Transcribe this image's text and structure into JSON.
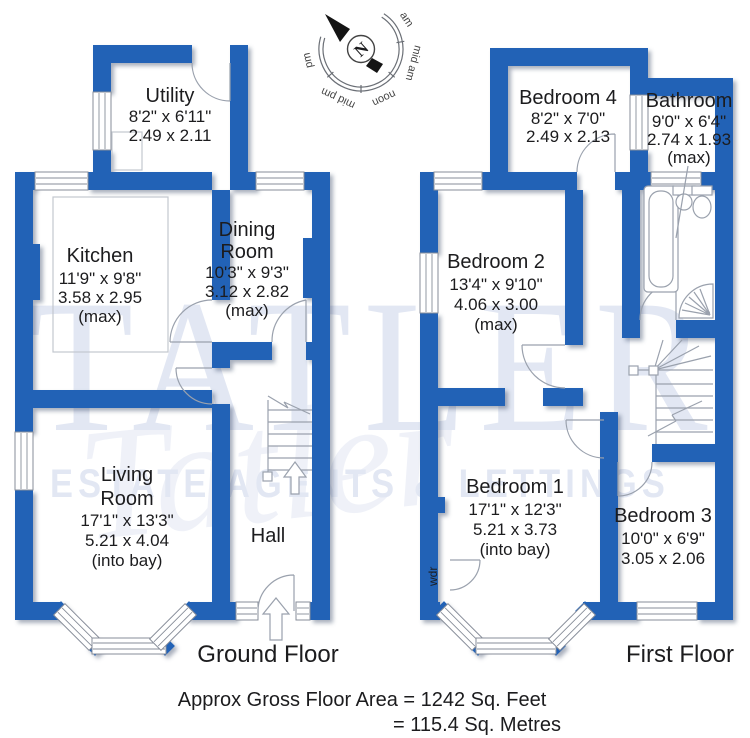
{
  "compass": {
    "north": "N",
    "sun_labels": [
      "am",
      "mid am",
      "noon",
      "mid pm",
      "pm"
    ]
  },
  "watermark": {
    "name": "TATLER",
    "script": "Tatler",
    "tagline": "ESTATE AGENTS & LETTINGS"
  },
  "ground_floor": {
    "label": "Ground Floor",
    "utility": {
      "name": "Utility",
      "imperial": "8'2\"  x  6'11\"",
      "metric": "2.49  x  2.11"
    },
    "kitchen": {
      "name": "Kitchen",
      "imperial": "11'9\" x  9'8\"",
      "metric": "3.58  x  2.95",
      "note": "(max)"
    },
    "dining": {
      "name_line1": "Dining",
      "name_line2": "Room",
      "imperial": "10'3\" x  9'3\"",
      "metric": "3.12  x  2.82",
      "note": "(max)"
    },
    "living": {
      "name_line1": "Living",
      "name_line2": "Room",
      "imperial": "17'1\" x 13'3\"",
      "metric": "5.21  x  4.04",
      "note": "(into bay)"
    },
    "hall": {
      "name": "Hall"
    }
  },
  "first_floor": {
    "label": "First Floor",
    "bedroom4": {
      "name": "Bedroom 4",
      "imperial": "8'2\"  x  7'0\"",
      "metric": "2.49  x  2.13"
    },
    "bathroom": {
      "name": "Bathroom",
      "imperial": "9'0\"  x  6'4\"",
      "metric": "2.74  x  1.93",
      "note": "(max)"
    },
    "bedroom2": {
      "name": "Bedroom 2",
      "imperial": "13'4\" x 9'10\"",
      "metric": "4.06  x  3.00",
      "note": "(max)"
    },
    "bedroom1": {
      "name": "Bedroom 1",
      "imperial": "17'1\"  x  12'3\"",
      "metric": "5.21  x  3.73",
      "note": "(into bay)"
    },
    "bedroom3": {
      "name": "Bedroom 3",
      "imperial": "10'0\"  x  6'9\"",
      "metric": "3.05  x  2.06"
    },
    "wardrobe": "wdr"
  },
  "footer": {
    "line1": "Approx Gross Floor Area  =  1242  Sq. Feet",
    "line2": "=  115.4  Sq. Metres"
  },
  "colors": {
    "wall_blue": "#2262b6",
    "watermark": "#e2e7f3",
    "plan_line": "#9aa1ad"
  }
}
